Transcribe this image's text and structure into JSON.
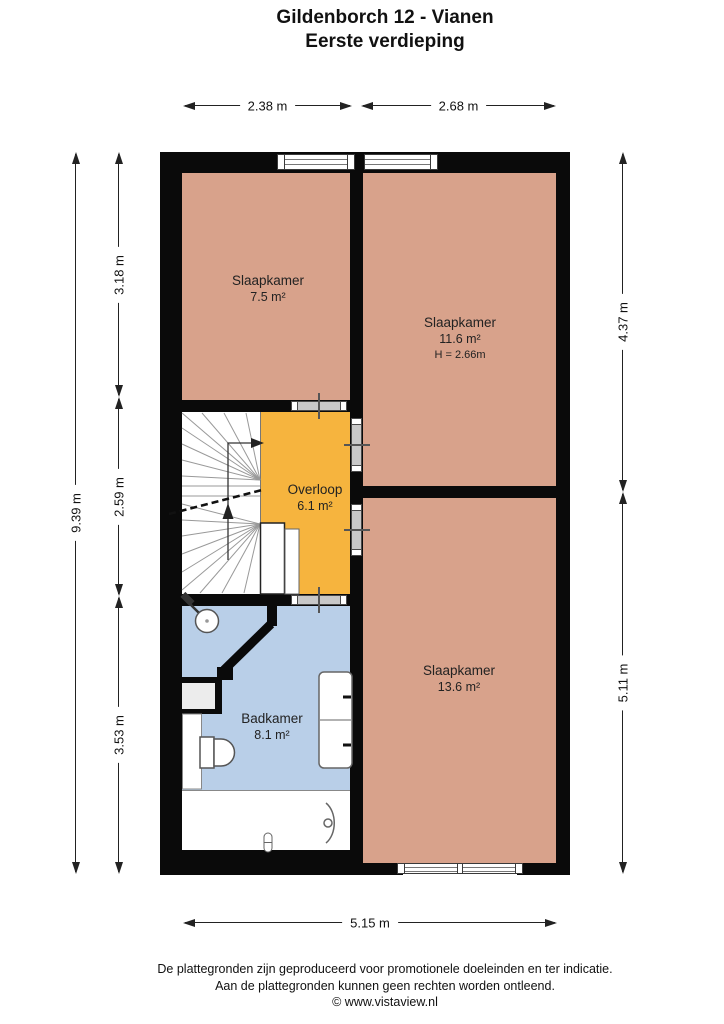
{
  "title": {
    "line1": "Gildenborch 12 - Vianen",
    "line2": "Eerste verdieping"
  },
  "dims": {
    "top": [
      "2.38 m",
      "2.68 m"
    ],
    "left_total": "9.39 m",
    "left_segments": [
      "3.18 m",
      "2.59 m",
      "3.53 m"
    ],
    "right_segments": [
      "4.37 m",
      "5.11 m"
    ],
    "bottom": "5.15 m"
  },
  "rooms": {
    "bedroom_small": {
      "name": "Slaapkamer",
      "area": "7.5 m²"
    },
    "bedroom_mid": {
      "name": "Slaapkamer",
      "area": "11.6 m²",
      "ceiling": "H = 2.66m"
    },
    "landing": {
      "name": "Overloop",
      "area": "6.1 m²"
    },
    "bathroom": {
      "name": "Badkamer",
      "area": "8.1 m²"
    },
    "bedroom_large": {
      "name": "Slaapkamer",
      "area": "13.6 m²"
    }
  },
  "colors": {
    "bedroom": "#d8a28b",
    "landing": "#f6b43e",
    "bathroom": "#b9cfe8",
    "wall": "#0a0a0a"
  },
  "footer": {
    "line1": "De plattegronden zijn geproduceerd voor promotionele doeleinden en ter indicatie.",
    "line2": "Aan de plattegronden kunnen geen rechten worden ontleend.",
    "line3": "© www.vistaview.nl"
  }
}
